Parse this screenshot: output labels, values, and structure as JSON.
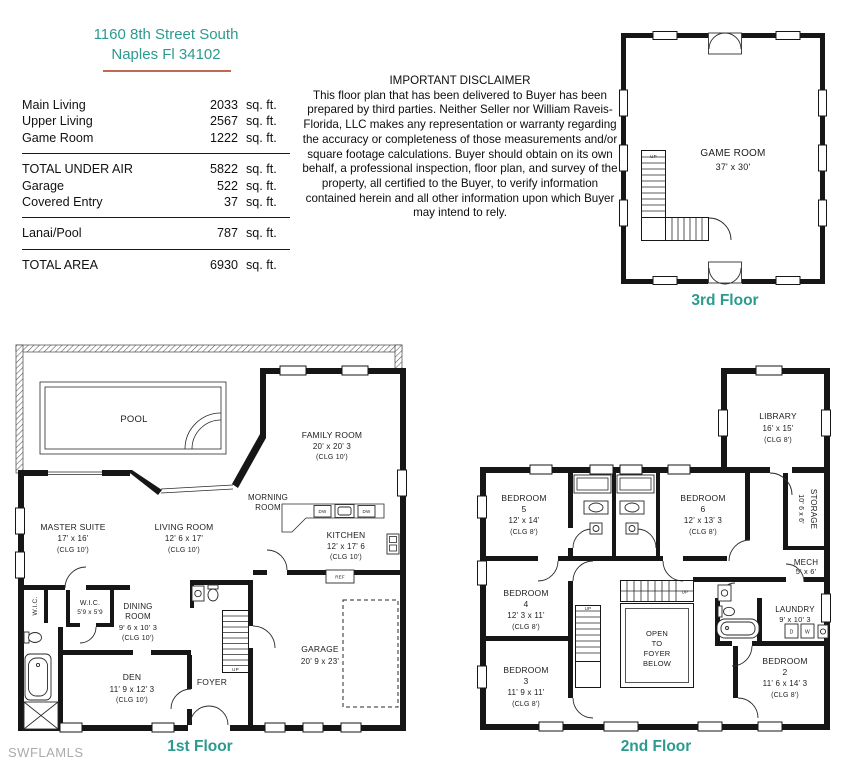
{
  "colors": {
    "teal": "#2b9a8f",
    "underline": "#bd6a52",
    "watermark": "#ababab",
    "line": "#161616"
  },
  "address": {
    "line1": "1160 8th Street South",
    "line2": "Naples Fl 34102"
  },
  "area_table": {
    "unit": "sq. ft.",
    "rows": [
      {
        "label": "Main Living",
        "value": "2033"
      },
      {
        "label": "Upper Living",
        "value": "2567"
      },
      {
        "label": "Game Room",
        "value": "1222"
      },
      {
        "label": "TOTAL UNDER AIR",
        "value": "5822"
      },
      {
        "label": "Garage",
        "value": "522"
      },
      {
        "label": "Covered Entry",
        "value": "37"
      },
      {
        "label": "Lanai/Pool",
        "value": "787"
      },
      {
        "label": "TOTAL AREA",
        "value": "6930"
      }
    ]
  },
  "disclaimer": {
    "title": "IMPORTANT DISCLAIMER",
    "body": "This floor plan that has been delivered to Buyer has been prepared by third parties. Neither Seller nor William Raveis-Florida, LLC makes any representation or warranty regarding the accuracy or completeness of those measurements and/or square footage calculations. Buyer should obtain on its own behalf, a professional inspection, floor plan, and survey of the property, all certified to the Buyer, to verify information contained herein and all other information upon which Buyer may intend to rely."
  },
  "floors": {
    "third": {
      "label": "3rd Floor",
      "game_room": {
        "name": "GAME ROOM",
        "dims": "37' x 30'"
      },
      "up": "UP"
    },
    "first": {
      "label": "1st Floor",
      "pool": "POOL",
      "family_room": {
        "name": "FAMILY ROOM",
        "dims": "20' x 20' 3",
        "clg": "(CLG 10')"
      },
      "morning_room": {
        "line1": "MORNING",
        "line2": "ROOM"
      },
      "master_suite": {
        "name": "MASTER SUITE",
        "dims": "17' x 16'",
        "clg": "(CLG 10')"
      },
      "living_room": {
        "name": "LIVING ROOM",
        "dims": "12' 6 x 17'",
        "clg": "(CLG 10')"
      },
      "kitchen": {
        "name": "KITCHEN",
        "dims": "12' x 17' 6",
        "clg": "(CLG 10')"
      },
      "wic": {
        "name": "W.I.C.",
        "dims": "5'9 x 5'9"
      },
      "wic_side": "W.I.C.",
      "dining_room": {
        "line1": "DINING",
        "line2": "ROOM",
        "dims": "9' 6 x 10' 3",
        "clg": "(CLG 10')"
      },
      "den": {
        "name": "DEN",
        "dims": "11' 9 x 12' 3",
        "clg": "(CLG 10')"
      },
      "foyer": "FOYER",
      "garage": {
        "name": "GARAGE",
        "dims": "20' 9 x 23'"
      },
      "appliances": {
        "dw": "DW",
        "ref": "REF"
      },
      "up": "UP"
    },
    "second": {
      "label": "2nd Floor",
      "library": {
        "name": "LIBRARY",
        "dims": "16' x 15'",
        "clg": "(CLG 8')"
      },
      "bedroom5": {
        "name": "BEDROOM",
        "num": "5",
        "dims": "12' x 14'",
        "clg": "(CLG 8')"
      },
      "bedroom6": {
        "name": "BEDROOM",
        "num": "6",
        "dims": "12' x 13' 3",
        "clg": "(CLG 8')"
      },
      "bedroom4": {
        "name": "BEDROOM",
        "num": "4",
        "dims": "12' 3 x 11'",
        "clg": "(CLG 8')"
      },
      "bedroom3": {
        "name": "BEDROOM",
        "num": "3",
        "dims": "11' 9 x 11'",
        "clg": "(CLG 8')"
      },
      "bedroom2": {
        "name": "BEDROOM",
        "num": "2",
        "dims": "11' 6 x 14' 3",
        "clg": "(CLG 8')"
      },
      "storage": {
        "name": "STORAGE",
        "dims": "10' 6 x 6'"
      },
      "mech": {
        "name": "MECH",
        "dims": "5' x 6'"
      },
      "laundry": {
        "name": "LAUNDRY",
        "dims": "9' x 10' 3"
      },
      "open_foyer": {
        "line1": "OPEN",
        "line2": "TO",
        "line3": "FOYER",
        "line4": "BELOW"
      },
      "appliances": {
        "d": "D",
        "w": "W"
      },
      "up": "UP"
    }
  },
  "watermark": "SWFLAMLS"
}
